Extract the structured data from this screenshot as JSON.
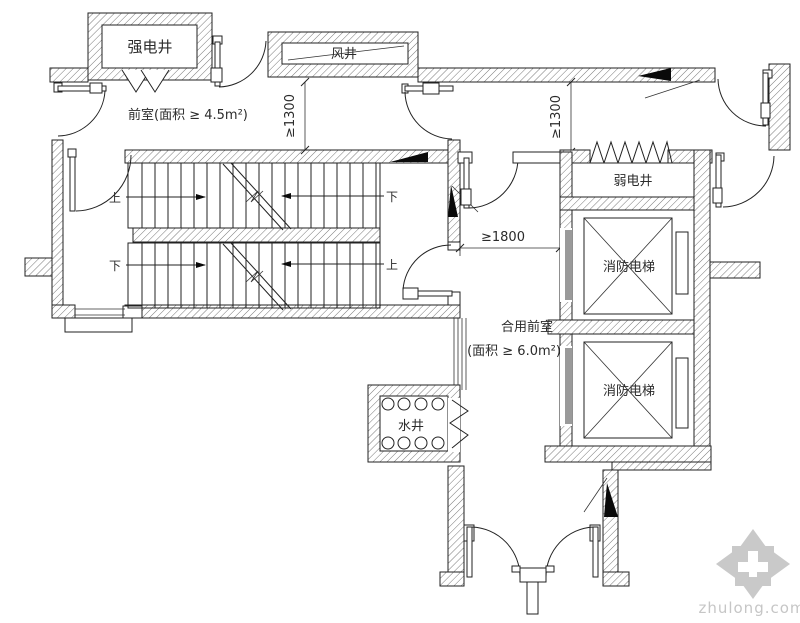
{
  "plan": {
    "labels": {
      "strong_electric_shaft": "强电井",
      "air_shaft": "风井",
      "front_room": "前室(面积 ≥ 4.5m²)",
      "weak_electric_shaft": "弱电井",
      "fire_elevator": "消防电梯",
      "shared_front_room": "合用前室",
      "shared_front_room_area": "(面积 ≥ 6.0m²)",
      "water_shaft": "水井",
      "up": "上",
      "down": "下"
    },
    "dimensions": {
      "front_room_clearance": "≥1300",
      "elevator_lobby_clearance": "≥1300",
      "shared_front_room_clearance": "≥1800"
    },
    "colors": {
      "line": "#222222",
      "black_fill": "#0a0a0a",
      "elevator_door": "#9a9a9a",
      "watermark": "#c9c9c9"
    }
  },
  "watermark": {
    "text": "zhulong.com"
  }
}
